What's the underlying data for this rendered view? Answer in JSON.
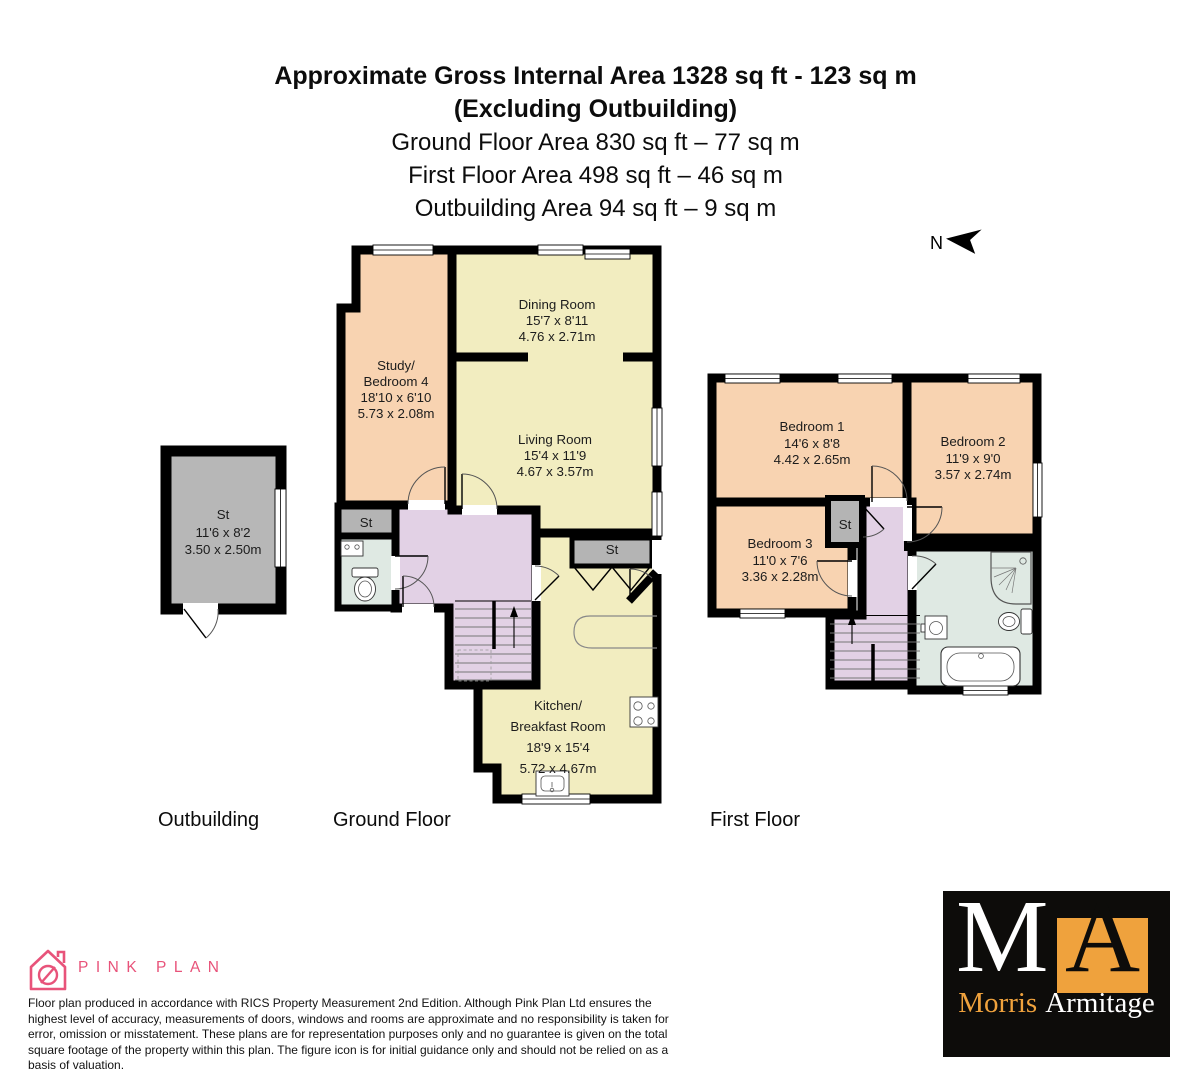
{
  "header": {
    "title_line1": "Approximate Gross Internal Area 1328 sq ft - 123 sq m",
    "title_line2": "(Excluding Outbuilding)",
    "ground_area": "Ground Floor Area 830 sq ft – 77 sq m",
    "first_area": "First Floor Area 498 sq ft – 46 sq m",
    "outbuilding_area": "Outbuilding Area 94 sq ft – 9 sq m"
  },
  "compass": {
    "north_label": "N"
  },
  "floor_labels": {
    "outbuilding": "Outbuilding",
    "ground": "Ground Floor",
    "first": "First Floor"
  },
  "rooms": {
    "outbuilding_store": {
      "name": "St",
      "imperial": "11'6 x 8'2",
      "metric": "3.50 x 2.50m"
    },
    "dining": {
      "name": "Dining Room",
      "imperial": "15'7 x 8'11",
      "metric": "4.76 x 2.71m"
    },
    "study": {
      "name_line1": "Study/",
      "name_line2": "Bedroom 4",
      "imperial": "18'10 x 6'10",
      "metric": "5.73 x 2.08m"
    },
    "living": {
      "name": "Living Room",
      "imperial": "15'4 x 11'9",
      "metric": "4.67 x 3.57m"
    },
    "kitchen": {
      "name_line1": "Kitchen/",
      "name_line2": "Breakfast Room",
      "imperial": "18'9 x 15'4",
      "metric": "5.72 x 4.67m"
    },
    "ground_store_left": {
      "name": "St"
    },
    "ground_store_kitchen": {
      "name": "St"
    },
    "bedroom1": {
      "name": "Bedroom 1",
      "imperial": "14'6 x 8'8",
      "metric": "4.42 x 2.65m"
    },
    "bedroom2": {
      "name": "Bedroom 2",
      "imperial": "11'9 x 9'0",
      "metric": "3.57 x 2.74m"
    },
    "bedroom3": {
      "name": "Bedroom 3",
      "imperial": "11'0 x 7'6",
      "metric": "3.36 x 2.28m"
    },
    "first_store": {
      "name": "St"
    }
  },
  "footer": {
    "brand": "PINK PLAN",
    "disclaimer": "Floor plan produced in accordance with RICS Property Measurement 2nd Edition. Although Pink Plan Ltd ensures the highest level of accuracy, measurements of doors, windows and rooms are approximate and no responsibility is taken for error, omission or misstatement. These plans are for representation purposes only and no guarantee is given on the total square footage of the property within this plan. The figure icon is for initial guidance only and should not be relied on as a basis of valuation."
  },
  "agency_logo": {
    "letter_m": "M",
    "letter_a": "A",
    "word1": "Morris",
    "word2": "Armitage"
  },
  "colors": {
    "wall": "#000000",
    "room_peach": "#f8d3b1",
    "room_yellow": "#f2edc0",
    "room_lavender": "#e2d1e5",
    "room_gray": "#b4b4b4",
    "room_bath": "#dfe9e3",
    "brand_pink": "#e8537a",
    "brand_orange": "#efa23d",
    "logo_background": "#0d0c0a"
  }
}
